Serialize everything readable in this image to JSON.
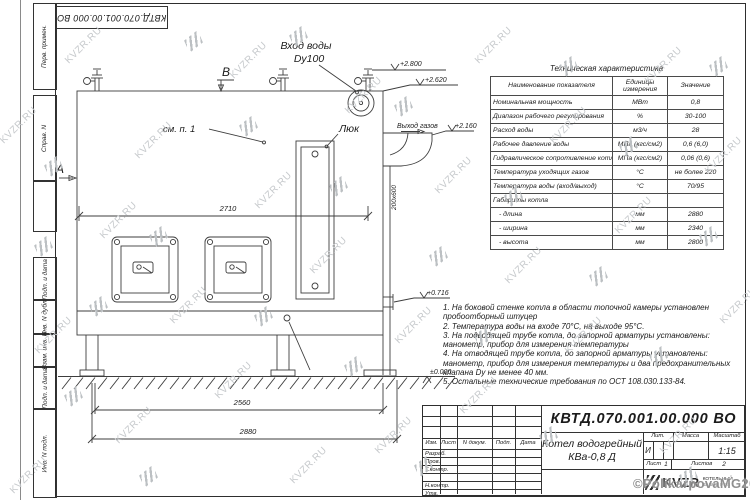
{
  "sheet": {
    "designation": "КВТД.070.001.00.000  ВО",
    "watermark": "KVZR.RU",
    "copyright": "©PolikarpovaMG2021"
  },
  "colors": {
    "line": "#3d3d3d",
    "watermark": "#c6c9cc"
  },
  "margin": {
    "labels": [
      "Перв. примен.",
      "Справ. N",
      "Подп. и дата",
      "Инв. N дубл.",
      "Взам. инв. N",
      "Подп. и дата",
      "Инв. N подл."
    ]
  },
  "drawing": {
    "labels": {
      "view_b": "В",
      "view_a": "А",
      "water_inlet_1": "Вход воды",
      "water_inlet_2": "Dy100",
      "hatch": "Люк",
      "see_note": "см. п. 1",
      "gas_outlet": "Выход газов",
      "duct_size": "200х600"
    },
    "elevations": [
      "+2.800",
      "+2.620",
      "+2.160",
      "+0.716",
      "±0.000"
    ],
    "dimensions": [
      "2710",
      "2560",
      "2880"
    ]
  },
  "spec_table": {
    "title": "Техническая характеристика",
    "headers": [
      "Наименование показателя",
      "Единицы измерения",
      "Значение"
    ],
    "rows": [
      [
        "Номинальная мощность",
        "МВт",
        "0,8"
      ],
      [
        "Диапазон рабочего регулирования",
        "%",
        "30-100"
      ],
      [
        "Расход воды",
        "м3/ч",
        "28"
      ],
      [
        "Рабочее давление воды",
        "МПа (кгс/см2)",
        "0,6 (6,0)"
      ],
      [
        "Гидравлическое сопротивление котла",
        "МПа (кгс/см2)",
        "0,06 (0,6)"
      ],
      [
        "Температура уходящих газов",
        "°С",
        "не более 220"
      ],
      [
        "Температура воды (вход/выход)",
        "°С",
        "70/95"
      ],
      [
        "Габариты котла",
        "",
        ""
      ],
      [
        "- длина",
        "мм",
        "2880"
      ],
      [
        "- ширина",
        "мм",
        "2340"
      ],
      [
        "- высота",
        "мм",
        "2800"
      ]
    ]
  },
  "notes": {
    "items": [
      "1. На боковой стенке котла в области топочной камеры установлен пробоотборный штуцер",
      "2. Температура воды на входе 70°С, на выходе 95°С.",
      "3. На подводящей трубе котла, до запорной арматуры установлены: манометр, прибор для измерения температуры",
      "4. На отводящей трубе котла, до запорной арматуры установлены: манометр, прибор для измерения температуры и два предохранительных клапана Dу не менее 40 мм.",
      "5. Остальные технические требования по ОСТ 108.030.133-84."
    ]
  },
  "title_block": {
    "designation": "КВТД.070.001.00.000  ВО",
    "name_line1": "Котел водогрейный",
    "name_line2": "КВа-0,8  Д",
    "col_headers": [
      "Изм.",
      "Лист",
      "N докум.",
      "Подп.",
      "Дата"
    ],
    "row_labels": [
      "Разраб.",
      "Пров.",
      "Т.контр.",
      "Н.контр.",
      "Утв."
    ],
    "lit_label": "Лит.",
    "lit_value": "И",
    "mass_label": "Масса",
    "scale_label": "Масштаб",
    "scale_value": "1:15",
    "sheet_label": "Лист",
    "sheet_value": "1",
    "sheets_label": "Листов",
    "sheets_value": "2",
    "company_logo": "KVZR",
    "company_name_1": "КОТЕЛЬНЫЙ",
    "company_name_2": "ЗАВОД РЭП"
  }
}
